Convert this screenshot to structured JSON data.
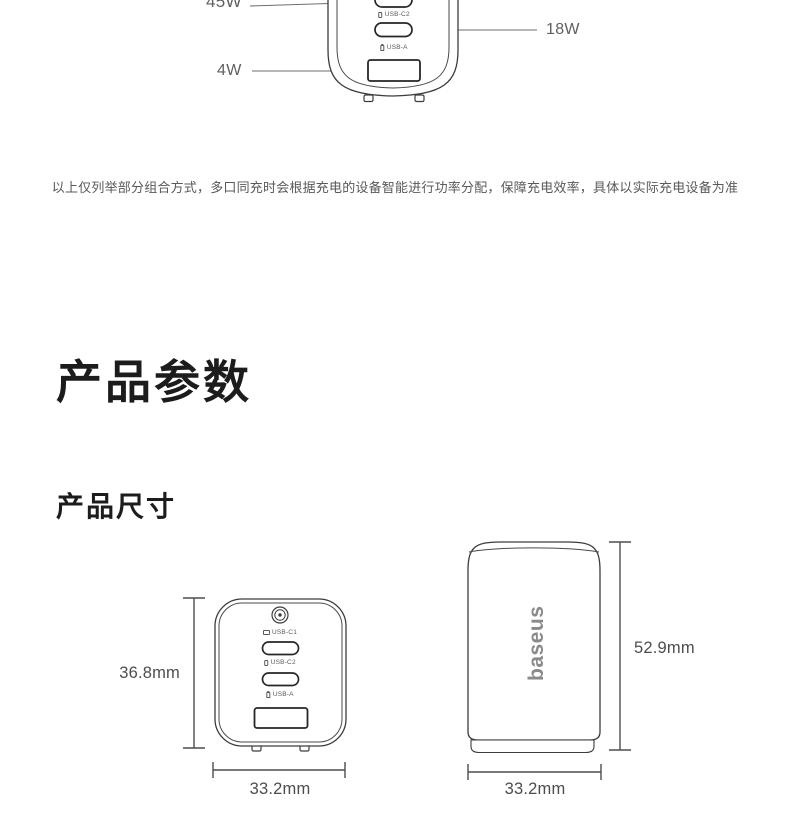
{
  "top_diagram": {
    "power_labels": {
      "usb_c1": "45W",
      "usb_c2": "18W",
      "usb_a": "4W"
    },
    "port_labels": {
      "usb_c2": "USB-C2",
      "usb_a": "USB-A"
    }
  },
  "disclaimer": "以上仅列举部分组合方式，多口同充时会根据充电的设备智能进行功率分配，保障充电效率，具体以实际充电设备为准",
  "sections": {
    "params_title": "产品参数",
    "size_title": "产品尺寸"
  },
  "front_view": {
    "port_labels": {
      "usb_c1": "USB-C1",
      "usb_c2": "USB-C2",
      "usb_a": "USB-A"
    },
    "height_label": "36.8mm",
    "width_label": "33.2mm"
  },
  "side_view": {
    "brand": "baseus",
    "height_label": "52.9mm",
    "width_label": "33.2mm"
  },
  "colors": {
    "background": "#ffffff",
    "heading": "#1c1c1c",
    "body_text": "#595959",
    "line_art": "#3c3c3c",
    "dimension": "#4d4d4d",
    "brand_gray": "#8a8a8a"
  }
}
